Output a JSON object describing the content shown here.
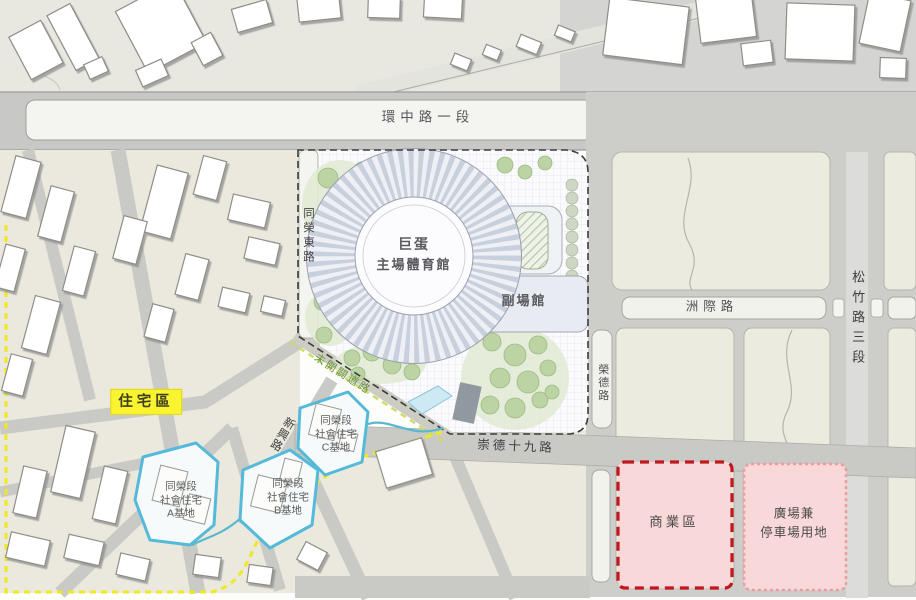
{
  "map": {
    "roads": {
      "huanzhong": "環中路一段",
      "tongrong_east": "同榮東路",
      "songzhu_sec3": "松竹路三段",
      "zhouji": "洲際路",
      "rongde": "榮德路",
      "chongde_19": "崇德十九路",
      "unopened": "未開闢道路",
      "xinxing": "新興路"
    },
    "venues": {
      "dome_line1": "巨蛋",
      "dome_line2": "主場體育館",
      "sub_venue": "副場館"
    },
    "zones": {
      "residential": "住宅區",
      "commercial": "商業區",
      "plaza_parking_line1": "廣場兼",
      "plaza_parking_line2": "停車場用地",
      "housing_a": {
        "l1": "同榮段",
        "l2": "社會住宅",
        "l3": "A基地"
      },
      "housing_b": {
        "l1": "同榮段",
        "l2": "社會住宅",
        "l3": "B基地"
      },
      "housing_c": {
        "l1": "同榮段",
        "l2": "社會住宅",
        "l3": "C基地"
      }
    },
    "colors": {
      "commercial_border": "#c0181c",
      "zone_fill_pink": "#f8d8d8",
      "site_outline_blue": "#55b9d9",
      "boundary_yellow": "#f0e920",
      "unopened_road_dash": "#ccdd66",
      "tree_green": "#bcd4a4",
      "residential_label_bg": "#f9f330",
      "stadium_ring": "#c9d0dd"
    }
  }
}
